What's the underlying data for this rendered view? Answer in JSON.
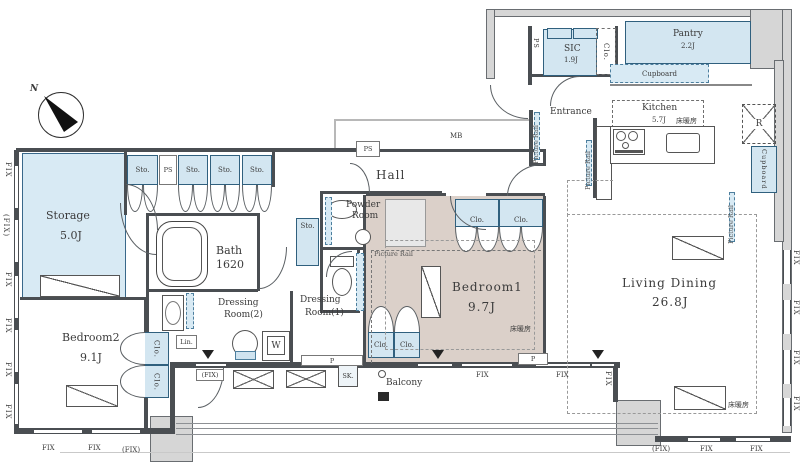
{
  "rooms": {
    "storage": {
      "name": "Storage",
      "area": "5.0J"
    },
    "bedroom1": {
      "name": "Bedroom1",
      "area": "9.7J"
    },
    "bedroom2": {
      "name": "Bedroom2",
      "area": "9.1J"
    },
    "living_dining": {
      "name": "Living Dining",
      "area": "26.8J"
    },
    "kitchen": {
      "name": "Kitchen",
      "area": "5.7J"
    },
    "bath": {
      "name": "Bath",
      "size": "1620"
    },
    "dressing_room_1": {
      "line1": "Dressing",
      "line2": "Room(1)"
    },
    "dressing_room_2": {
      "line1": "Dressing",
      "line2": "Room(2)"
    },
    "powder_room": {
      "line1": "Powder",
      "line2": "Room"
    },
    "sic": {
      "name": "SIC",
      "area": "1.9J"
    },
    "pantry": {
      "name": "Pantry",
      "area": "2.2J"
    },
    "hall": {
      "name": "Hall"
    },
    "entrance": {
      "name": "Entrance"
    },
    "balcony": {
      "name": "Balcony"
    }
  },
  "tags": {
    "sto": "Sto.",
    "clo": "Clo.",
    "ps": "PS",
    "mb": "MB",
    "lin": "Lin.",
    "w": "W",
    "r": "R",
    "sk": "SK.",
    "p": "P",
    "fix": "FIX",
    "fix_paren": "(FIX)",
    "north": "N",
    "picture_rail": "Picture Rail",
    "floor_heating": "床暖房",
    "cupboard": "Cupboard"
  },
  "colors": {
    "closet_fill": "#d3e6f1",
    "bedroom1_fill": "#dbd0c9",
    "wall": "#4a4e52",
    "pillar": "#d6d6d6"
  }
}
